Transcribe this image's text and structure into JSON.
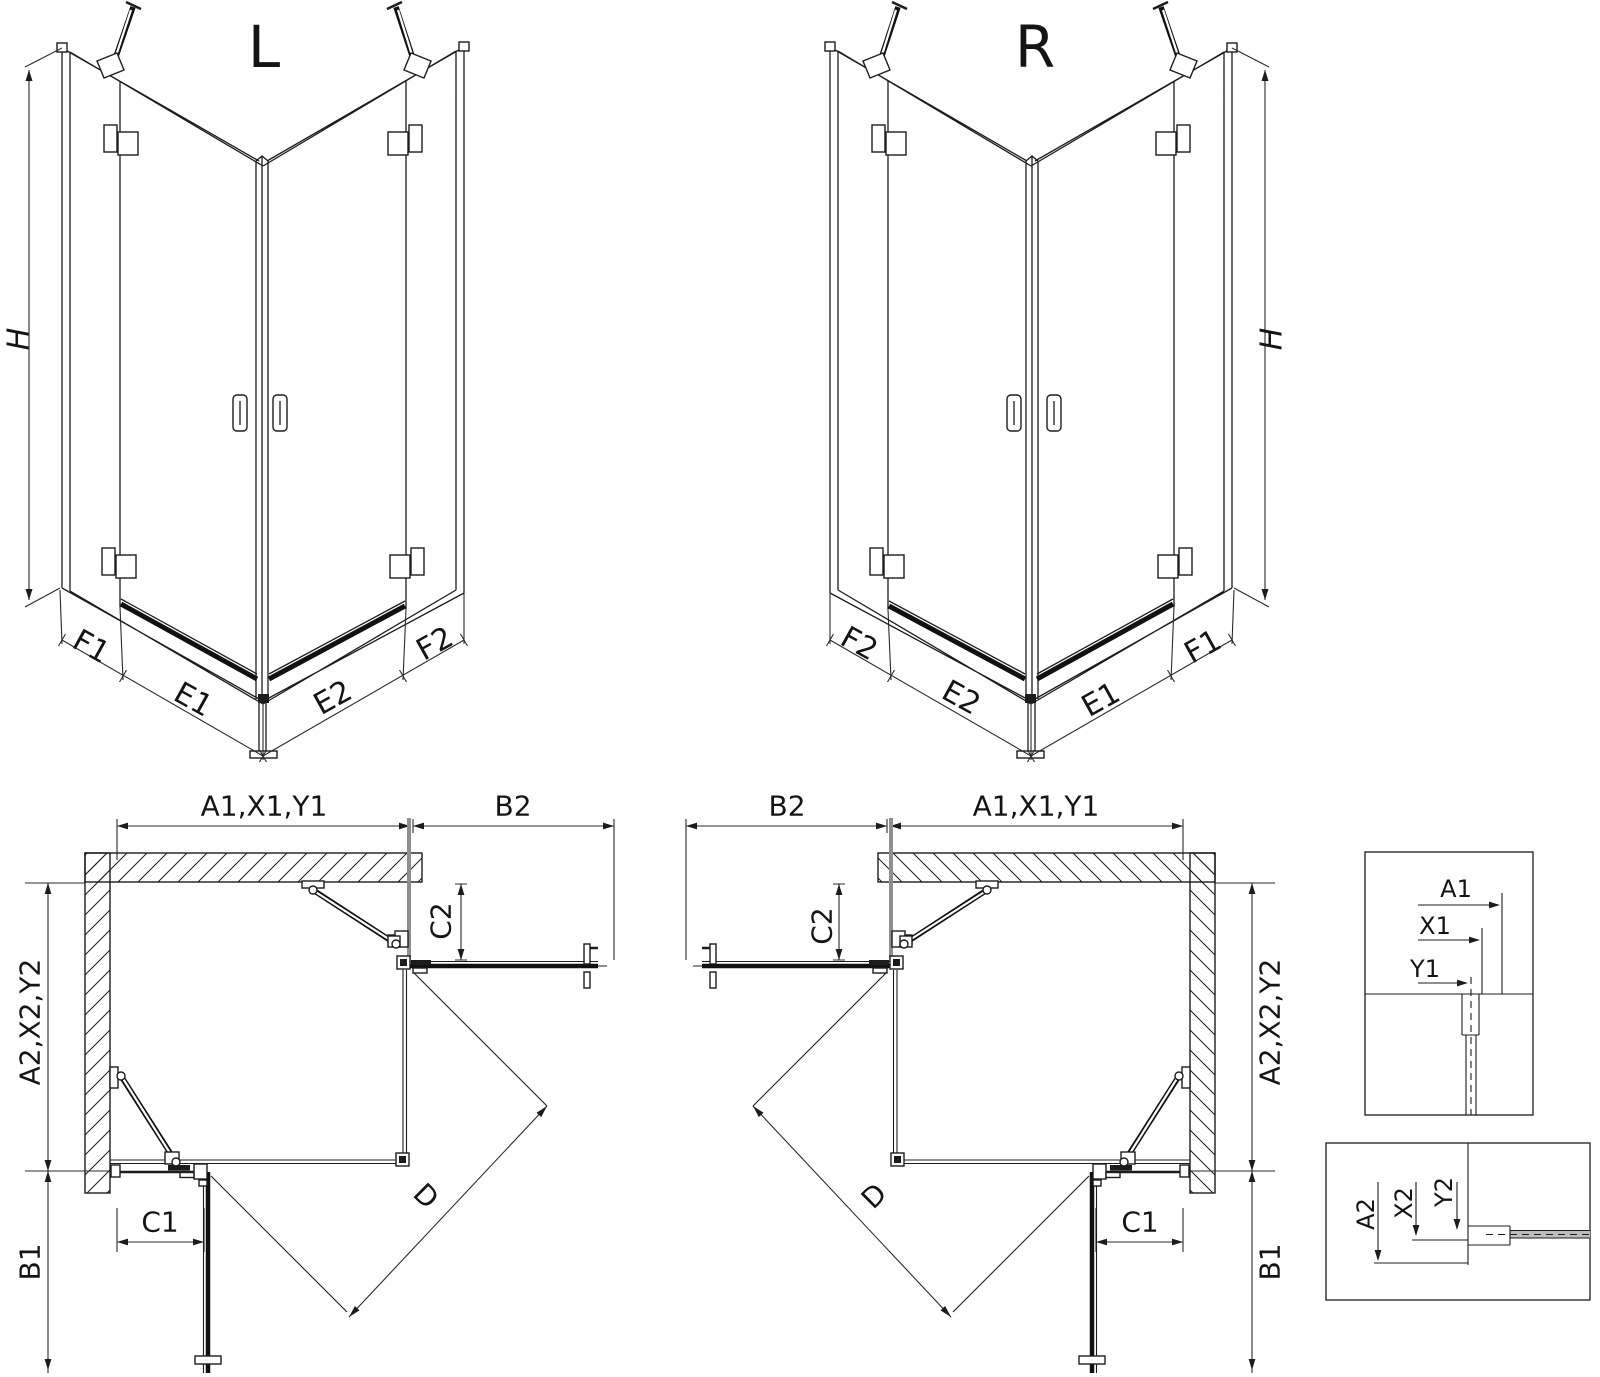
{
  "palette": {
    "background": "#ffffff",
    "line": "#1c1c1c",
    "glass_gray": "#8f8f8f",
    "glass_fill": "#bdbdbd"
  },
  "iso_left": {
    "title": "L",
    "dim_h": "H",
    "dim_f1": "F1",
    "dim_e1": "E1",
    "dim_e2": "E2",
    "dim_f2": "F2"
  },
  "iso_right": {
    "title": "R",
    "dim_h": "H",
    "dim_f1": "F1",
    "dim_e1": "E1",
    "dim_e2": "E2",
    "dim_f2": "F2"
  },
  "plan_left": {
    "dim_a1": "A1,X1,Y1",
    "dim_b2": "B2",
    "dim_c2": "C2",
    "dim_a2": "A2,X2,Y2",
    "dim_c1": "C1",
    "dim_b1": "B1",
    "dim_d": "D"
  },
  "plan_right": {
    "dim_a1": "A1,X1,Y1",
    "dim_b2": "B2",
    "dim_c2": "C2",
    "dim_a2": "A2,X2,Y2",
    "dim_c1": "C1",
    "dim_b1": "B1",
    "dim_d": "D"
  },
  "detail_top": {
    "dim_a1": "A1",
    "dim_x1": "X1",
    "dim_y1": "Y1"
  },
  "detail_bottom": {
    "dim_a2": "A2",
    "dim_x2": "X2",
    "dim_y2": "Y2"
  }
}
